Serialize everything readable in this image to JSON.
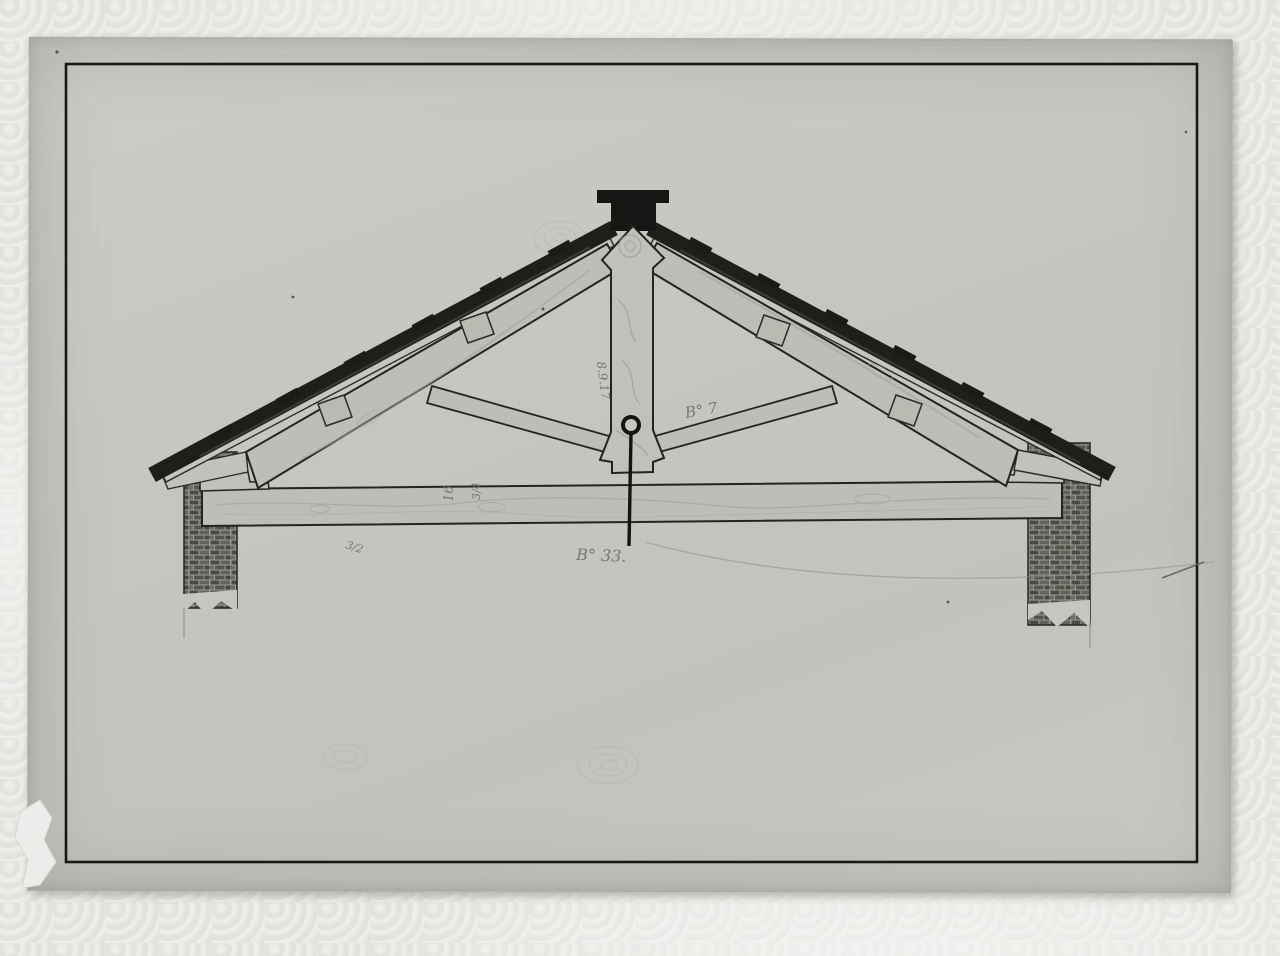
{
  "annotations": {
    "kingpost_date": {
      "text": "8.9.17"
    },
    "strut_label": {
      "text": "B° 7"
    },
    "beam_dim_1": {
      "text": "16"
    },
    "beam_dim_2": {
      "text": "3/4"
    },
    "beam_fraction": {
      "text": "3/2"
    },
    "bottom_label": {
      "text": "B° 33."
    }
  },
  "colors": {
    "styrofoam": "#e8e7e4",
    "paper": "#c5c6c1",
    "ink_border": "#181816",
    "wood_fill": "#bdbeb7",
    "wood_grain": "#9fa098",
    "roof_dark": "#1e1e1b",
    "brick_dark": "#4b4b45",
    "pencil": "#7c7d76"
  }
}
